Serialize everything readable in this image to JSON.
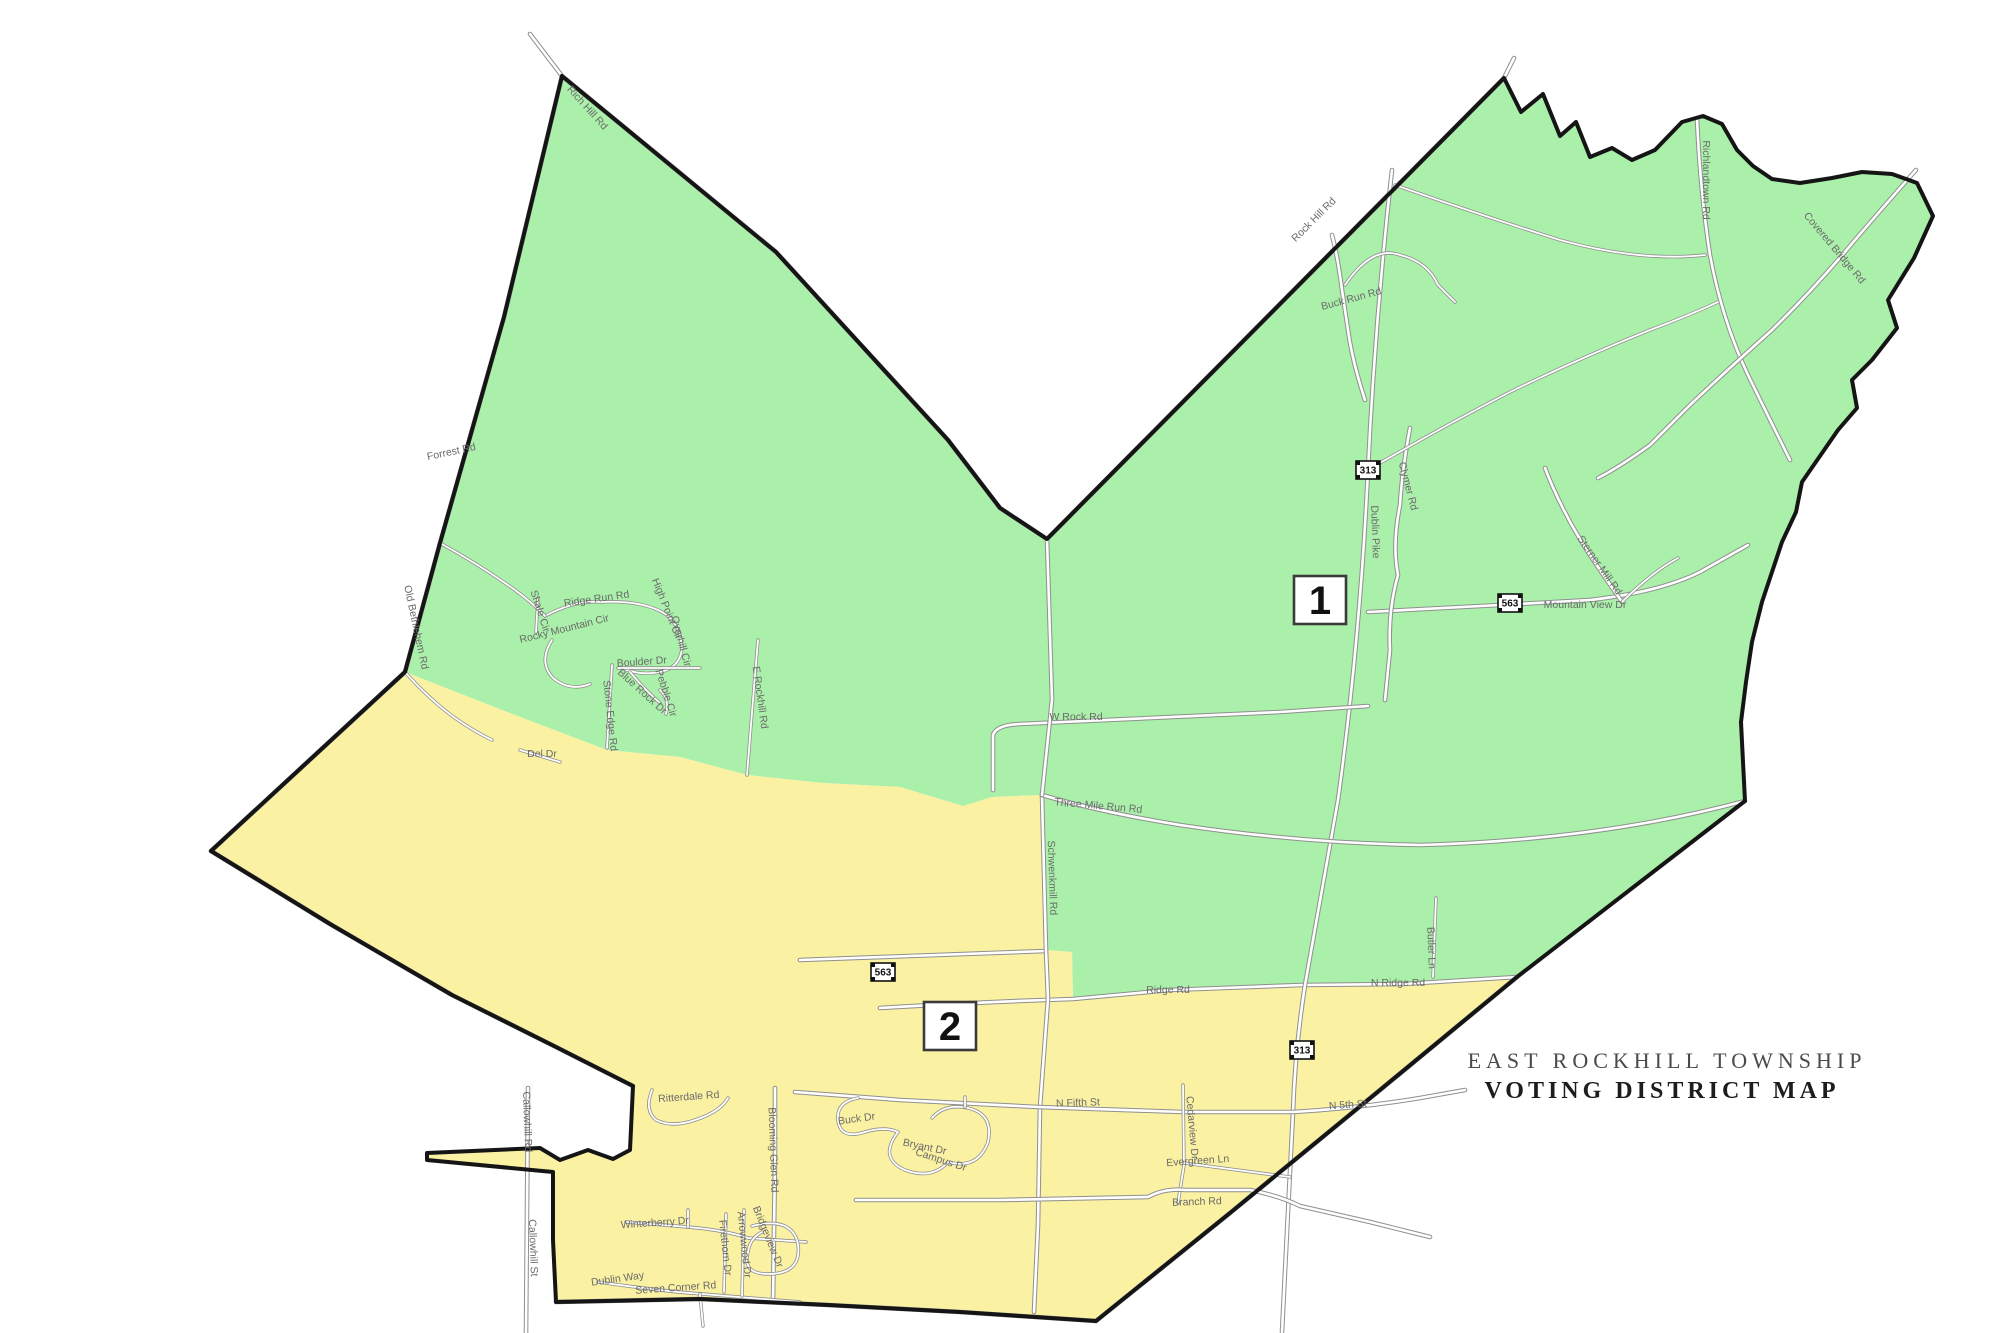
{
  "map": {
    "title_line1": "EAST ROCKHILL TOWNSHIP",
    "title_line2": "VOTING DISTRICT MAP",
    "colors": {
      "district1_fill": "#aaf0aa",
      "district2_fill": "#faf1a3",
      "boundary": "#151515",
      "road_casing": "#8f8f8f",
      "road_fill": "#ffffff",
      "label_text": "#6a6a6a"
    },
    "districts": [
      {
        "number": "1",
        "fill_key": "district1_fill",
        "box_x": 1294,
        "box_y": 576
      },
      {
        "number": "2",
        "fill_key": "district2_fill",
        "box_x": 924,
        "box_y": 1002
      }
    ],
    "route_shields": [
      {
        "route": "313",
        "x": 1368,
        "y": 470
      },
      {
        "route": "563",
        "x": 1510,
        "y": 603
      },
      {
        "route": "563",
        "x": 883,
        "y": 972
      },
      {
        "route": "313",
        "x": 1302,
        "y": 1050
      }
    ],
    "road_labels": [
      {
        "text": "Forrest Rd",
        "x": 452,
        "y": 455,
        "r": -12
      },
      {
        "text": "Rich Hill Rd",
        "x": 585,
        "y": 110,
        "r": 48
      },
      {
        "text": "Rock Hill Rd",
        "x": 1316,
        "y": 222,
        "r": -45
      },
      {
        "text": "Buck Run Rd",
        "x": 1352,
        "y": 302,
        "r": -15
      },
      {
        "text": "Richlandtown Rd",
        "x": 1703,
        "y": 180,
        "r": 90
      },
      {
        "text": "Covered Bridge Rd",
        "x": 1832,
        "y": 250,
        "r": 50
      },
      {
        "text": "Dublin Pike",
        "x": 1372,
        "y": 532,
        "r": 88
      },
      {
        "text": "Clymer Rd",
        "x": 1405,
        "y": 487,
        "r": 75
      },
      {
        "text": "Mountain View Dr",
        "x": 1585,
        "y": 608,
        "r": 0
      },
      {
        "text": "Sterner Mill Rd",
        "x": 1597,
        "y": 567,
        "r": 55
      },
      {
        "text": "W Rock Rd",
        "x": 1076,
        "y": 720,
        "r": 0
      },
      {
        "text": "Three Mile Run Rd",
        "x": 1098,
        "y": 809,
        "r": 5
      },
      {
        "text": "Schwenkmill Rd",
        "x": 1049,
        "y": 878,
        "r": 88
      },
      {
        "text": "Ridge Rd",
        "x": 1168,
        "y": 993,
        "r": 0
      },
      {
        "text": "N Ridge Rd",
        "x": 1398,
        "y": 986,
        "r": 0
      },
      {
        "text": "Butler Ln",
        "x": 1428,
        "y": 948,
        "r": 88
      },
      {
        "text": "E Rockhill Rd",
        "x": 757,
        "y": 698,
        "r": 82
      },
      {
        "text": "Ridge Run Rd",
        "x": 597,
        "y": 602,
        "r": -8
      },
      {
        "text": "Shale Cir",
        "x": 537,
        "y": 612,
        "r": 72
      },
      {
        "text": "Rocky Mountain Cir",
        "x": 565,
        "y": 632,
        "r": -14
      },
      {
        "text": "High Point Cir",
        "x": 664,
        "y": 610,
        "r": 68
      },
      {
        "text": "Overhill Cir",
        "x": 678,
        "y": 642,
        "r": 75
      },
      {
        "text": "Boulder Dr",
        "x": 642,
        "y": 665,
        "r": -4
      },
      {
        "text": "Blue Rock Dr",
        "x": 640,
        "y": 694,
        "r": 42
      },
      {
        "text": "Pebble Cir",
        "x": 663,
        "y": 694,
        "r": 72
      },
      {
        "text": "Stone Edge Rd",
        "x": 607,
        "y": 716,
        "r": 84
      },
      {
        "text": "Old Bethlehem Rd",
        "x": 413,
        "y": 628,
        "r": 78
      },
      {
        "text": "Del Dr",
        "x": 542,
        "y": 757,
        "r": 0
      },
      {
        "text": "N Fifth St",
        "x": 1078,
        "y": 1106,
        "r": -2
      },
      {
        "text": "N 5th St",
        "x": 1348,
        "y": 1108,
        "r": -4
      },
      {
        "text": "Cedarview Dr",
        "x": 1189,
        "y": 1128,
        "r": 85
      },
      {
        "text": "Evergreen Ln",
        "x": 1198,
        "y": 1164,
        "r": -4
      },
      {
        "text": "Branch Rd",
        "x": 1197,
        "y": 1205,
        "r": -2
      },
      {
        "text": "Blooming Glen Rd",
        "x": 770,
        "y": 1150,
        "r": 88
      },
      {
        "text": "Callowhill Rd",
        "x": 524,
        "y": 1122,
        "r": 88
      },
      {
        "text": "Callowhill St",
        "x": 530,
        "y": 1248,
        "r": 88
      },
      {
        "text": "Ritterdale Rd",
        "x": 689,
        "y": 1100,
        "r": -4
      },
      {
        "text": "Winterberry Dr",
        "x": 655,
        "y": 1226,
        "r": -4
      },
      {
        "text": "Dublin Way",
        "x": 618,
        "y": 1282,
        "r": -8
      },
      {
        "text": "Seven Corner Rd",
        "x": 676,
        "y": 1291,
        "r": -4
      },
      {
        "text": "Firethorn Dr",
        "x": 722,
        "y": 1248,
        "r": 84
      },
      {
        "text": "Arrowwood Dr",
        "x": 741,
        "y": 1245,
        "r": 84
      },
      {
        "text": "Bridgeview Dr",
        "x": 765,
        "y": 1238,
        "r": 68
      },
      {
        "text": "Bryant Dr",
        "x": 924,
        "y": 1150,
        "r": 12
      },
      {
        "text": "Campus Dr",
        "x": 940,
        "y": 1163,
        "r": 18
      },
      {
        "text": "Buck Dr",
        "x": 857,
        "y": 1122,
        "r": -8
      }
    ]
  }
}
